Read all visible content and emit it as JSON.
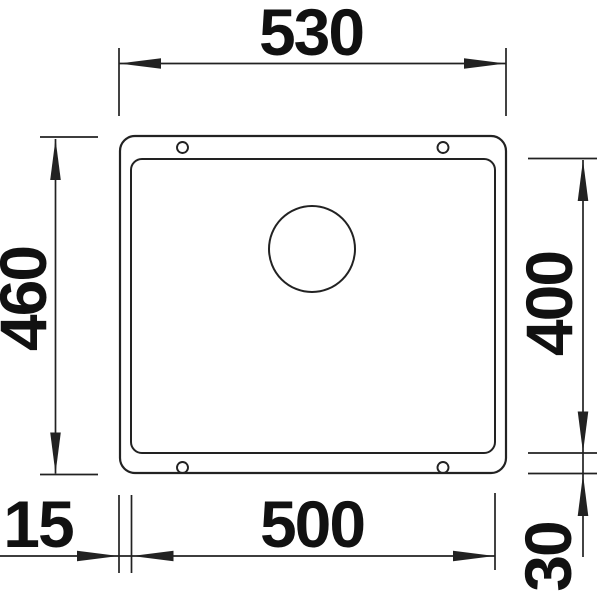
{
  "figure": {
    "kind": "sink-undermount-technical-drawing-top-view",
    "dimensions": {
      "outer_width": "530",
      "outer_height": "460",
      "bowl_height": "400",
      "bowl_width": "500",
      "rim_left": "15",
      "rim_bottom": "30"
    },
    "colors": {
      "line": "#222222",
      "text": "#111111",
      "background": "#ffffff"
    }
  }
}
